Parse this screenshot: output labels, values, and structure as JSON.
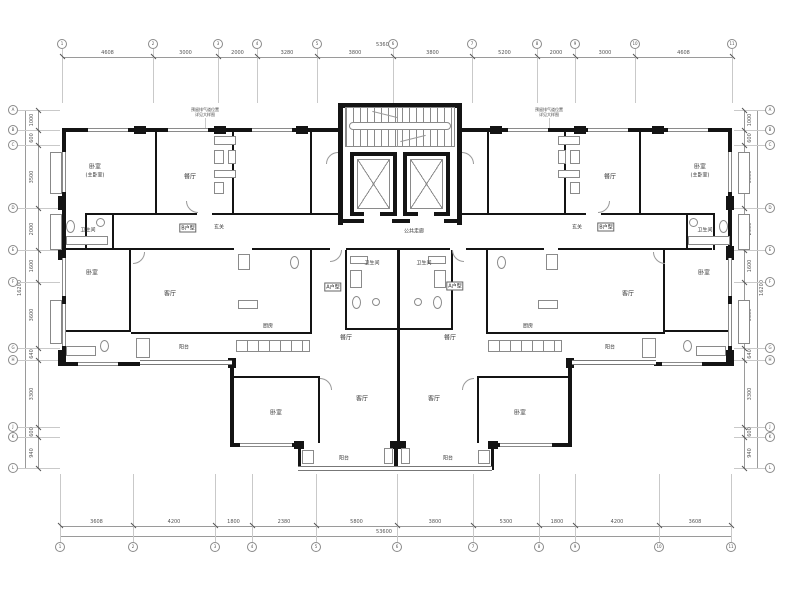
{
  "rooms": {
    "bedroom": "卧室",
    "master_sub": "(主卧室)",
    "dining": "餐厅",
    "living": "客厅",
    "balcony": "阳台",
    "bath": "卫生间",
    "kitchen": "厨房",
    "corridor": "公共走廊",
    "entry": "玄关"
  },
  "units": {
    "a": "A户型",
    "b": "B户型"
  },
  "notes": {
    "line1": "预留排气道位置",
    "line2": "详见大样图"
  },
  "grid": {
    "top": [
      "1",
      "2",
      "3",
      "4",
      "5",
      "6",
      "7",
      "8",
      "9",
      "10",
      "11"
    ],
    "bottom": [
      "1",
      "2",
      "3",
      "4",
      "5",
      "6",
      "7",
      "8",
      "9",
      "10",
      "11"
    ],
    "left": [
      "A",
      "B",
      "C",
      "D",
      "E",
      "F",
      "G",
      "H",
      "J",
      "K",
      "L"
    ],
    "right": [
      "A",
      "B",
      "C",
      "D",
      "E",
      "F",
      "G",
      "H",
      "J",
      "K",
      "L"
    ]
  },
  "dims": {
    "top": {
      "segments": [
        "4608",
        "3000",
        "2000",
        "3280",
        "3800",
        "3800",
        "5200",
        "2000",
        "3000",
        "4608"
      ],
      "overall": "53600"
    },
    "bottom": {
      "segments": [
        "3608",
        "4200",
        "1800",
        "2380",
        "5800",
        "3800",
        "5300",
        "1800",
        "4200",
        "3608"
      ],
      "overall": "53600"
    },
    "left": {
      "segments": [
        "1000",
        "600",
        "3500",
        "2000",
        "1600",
        "3600",
        "640",
        "3300",
        "600",
        "940"
      ],
      "overall": "16200"
    },
    "right": {
      "segments": [
        "1000",
        "600",
        "3500",
        "2000",
        "1600",
        "3600",
        "640",
        "3300",
        "600",
        "940"
      ],
      "overall": "16200"
    }
  },
  "colors": {
    "wall": "#141414",
    "line": "#8a8a8a",
    "grid_line": "#c9c9c9",
    "text": "#444444"
  }
}
